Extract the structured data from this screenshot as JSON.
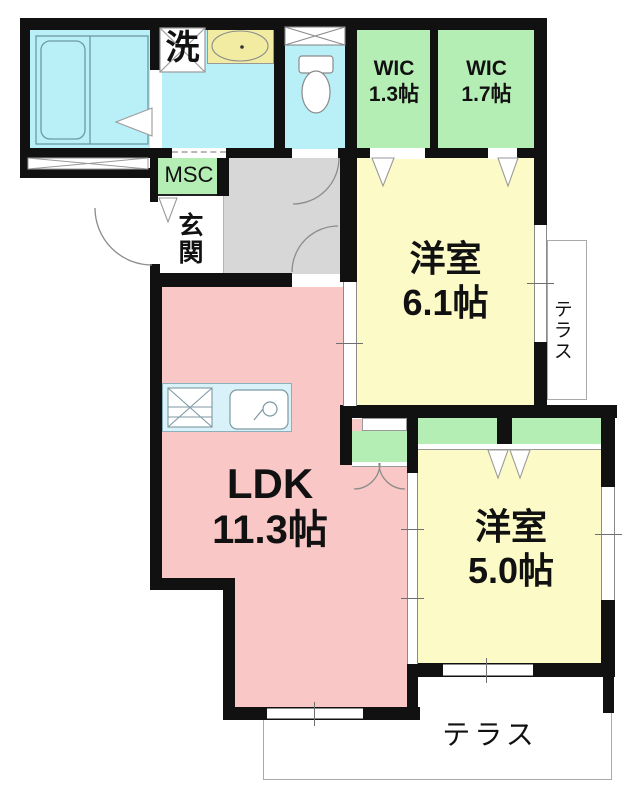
{
  "floor_plan": {
    "labels": {
      "laundry_mark": "洗",
      "wic_small": {
        "line1": "WIC",
        "line2": "1.3帖"
      },
      "wic_large": {
        "line1": "WIC",
        "line2": "1.7帖"
      },
      "msc": "MSC",
      "entrance": "玄関",
      "bedroom_main": {
        "line1": "洋室",
        "line2": "6.1帖"
      },
      "bedroom_second": {
        "line1": "洋室",
        "line2": "5.0帖"
      },
      "ldk": {
        "line1": "LDK",
        "line2": "11.3帖"
      },
      "terrace_side": "テラス",
      "terrace_bottom": "テラス"
    },
    "colors": {
      "wall_black": "#111111",
      "water_cyan": "#b9f0f8",
      "room_yellow": "#fcfac6",
      "basin_yellow": "#f2eca3",
      "closet_green": "#b5eeb5",
      "ldk_pink": "#f9c7c6",
      "hall_gray": "#d7d7d7",
      "counter_blue": "#d9f1f8",
      "line_gray": "#8a8a8a"
    }
  }
}
